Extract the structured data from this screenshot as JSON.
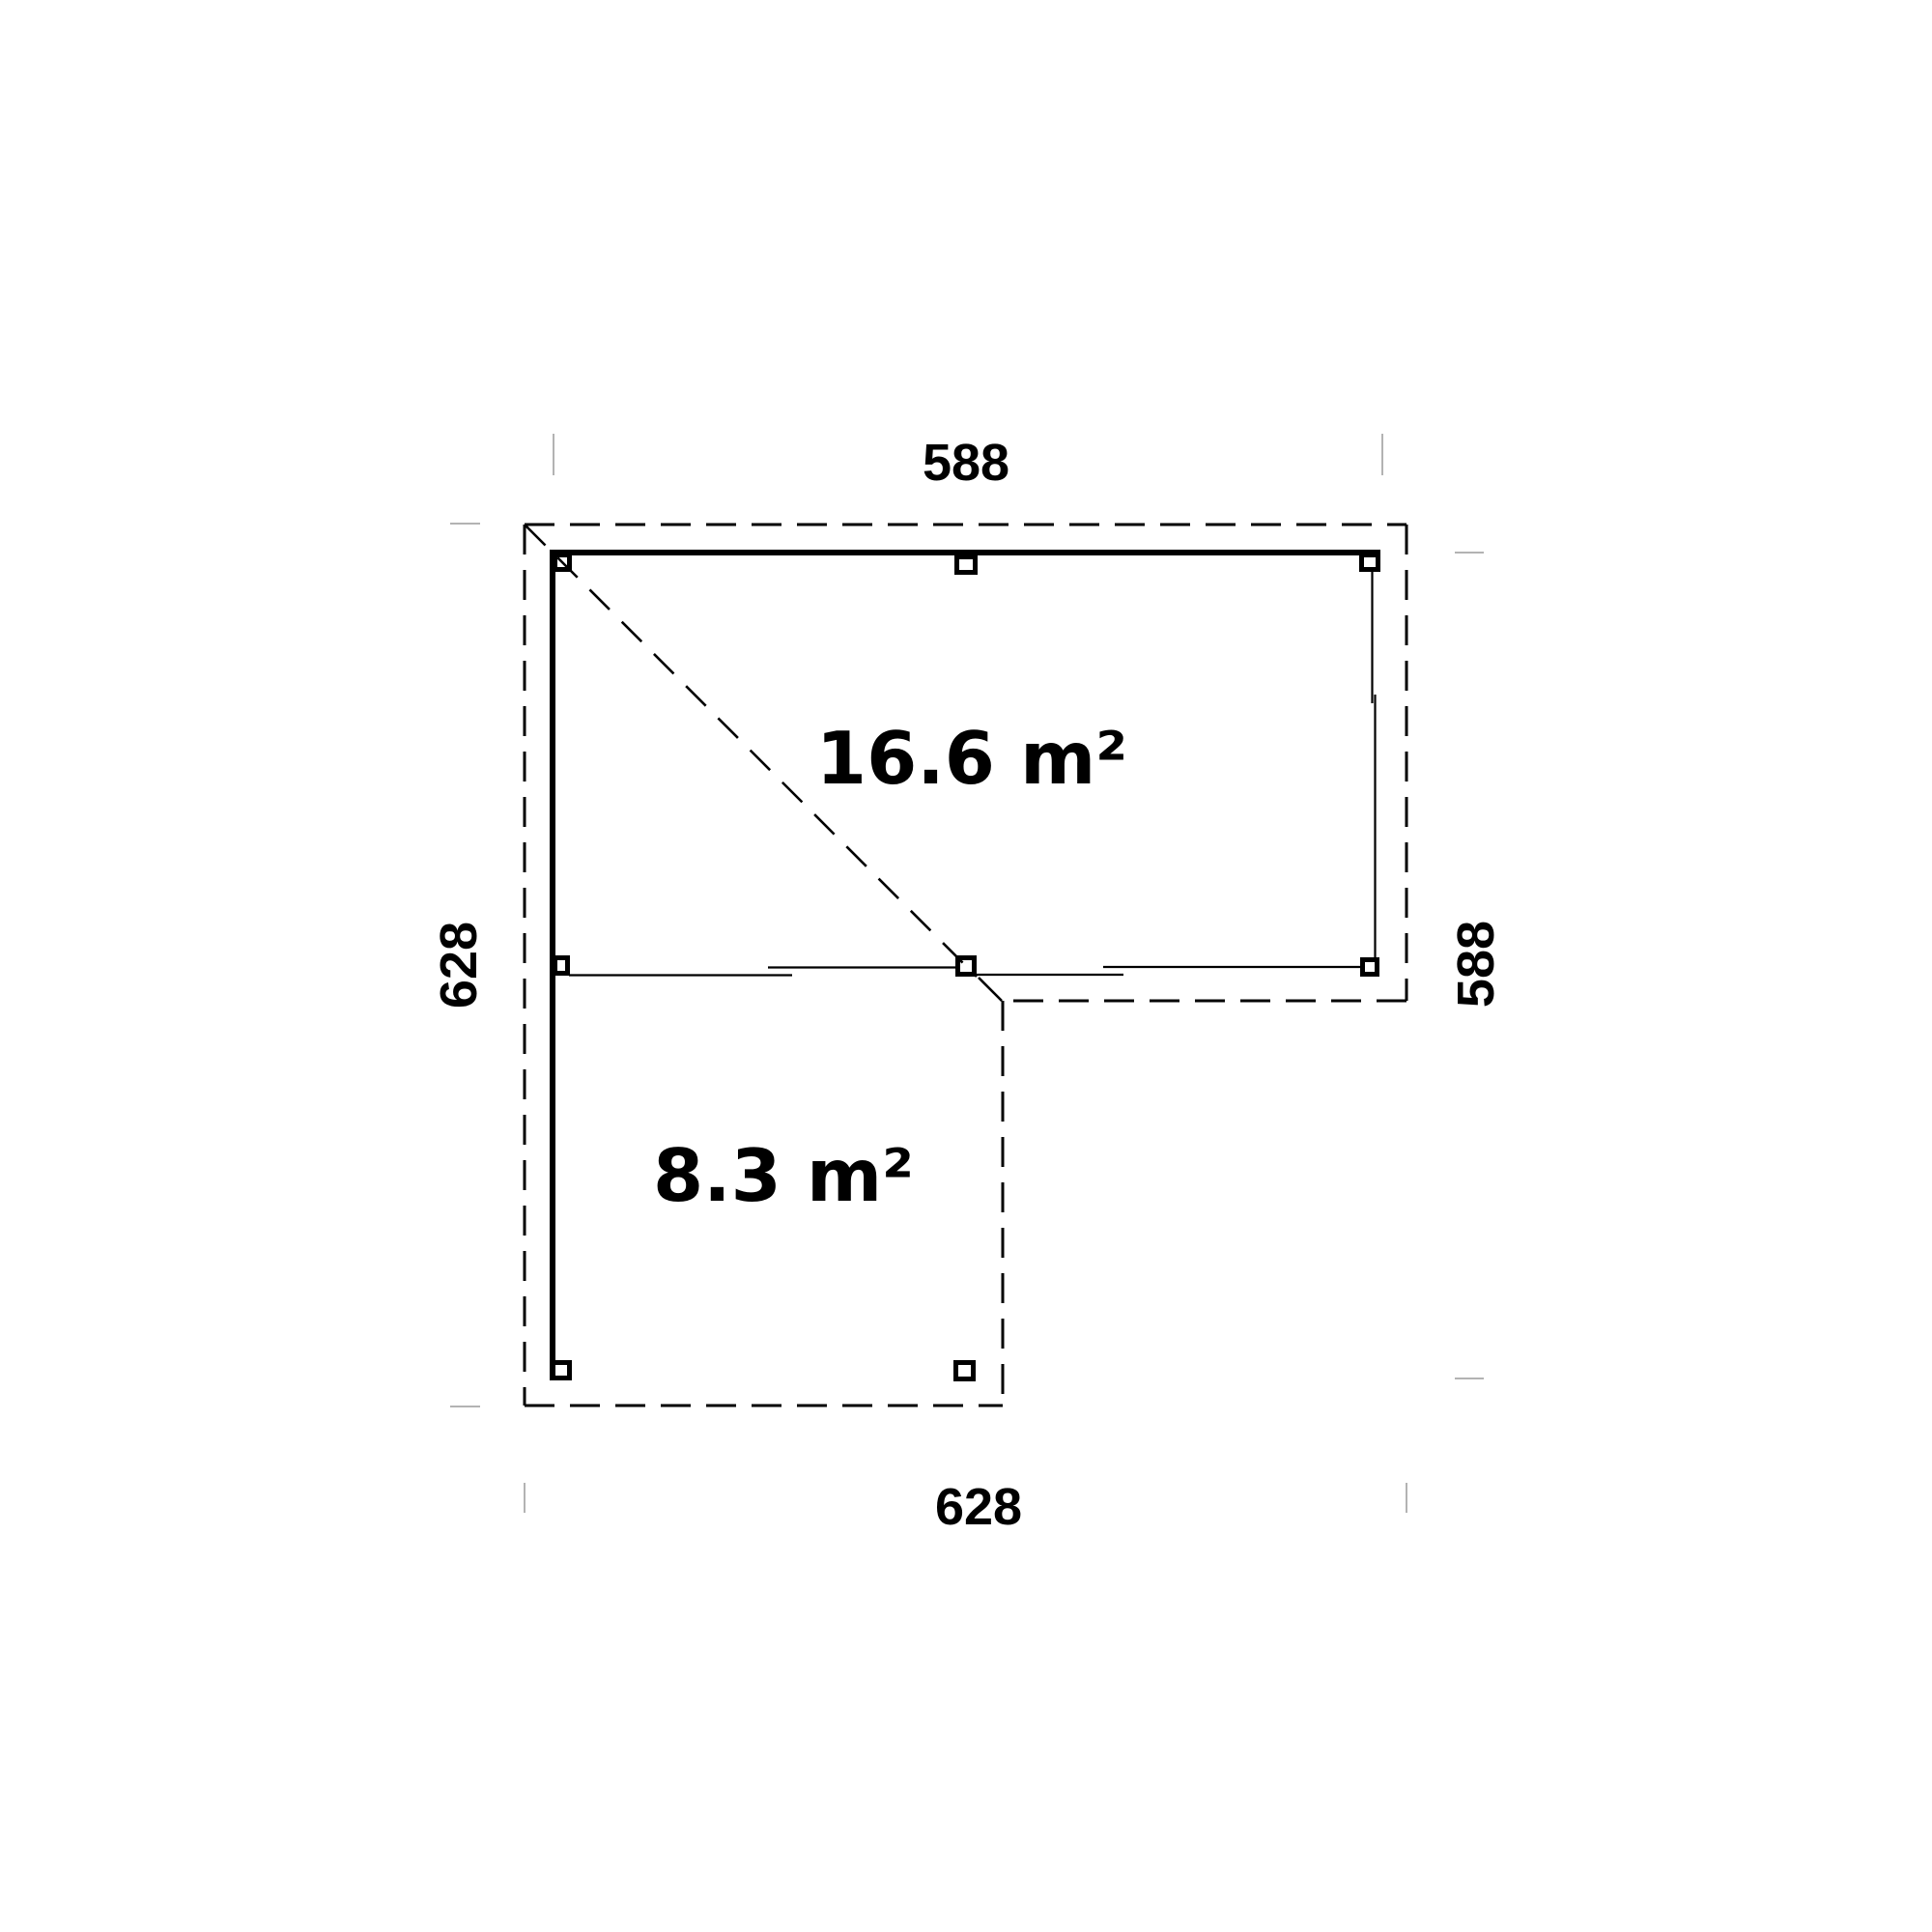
{
  "floor_plan": {
    "dimension_labels": {
      "top": "588",
      "right": "588",
      "left": "628",
      "bottom": "628"
    },
    "area_labels": {
      "main_room": "16.6 m²",
      "side_room": "8.3 m²"
    },
    "colors": {
      "line": "#000000",
      "tick": "#b3b3b3",
      "background": "#ffffff"
    }
  }
}
